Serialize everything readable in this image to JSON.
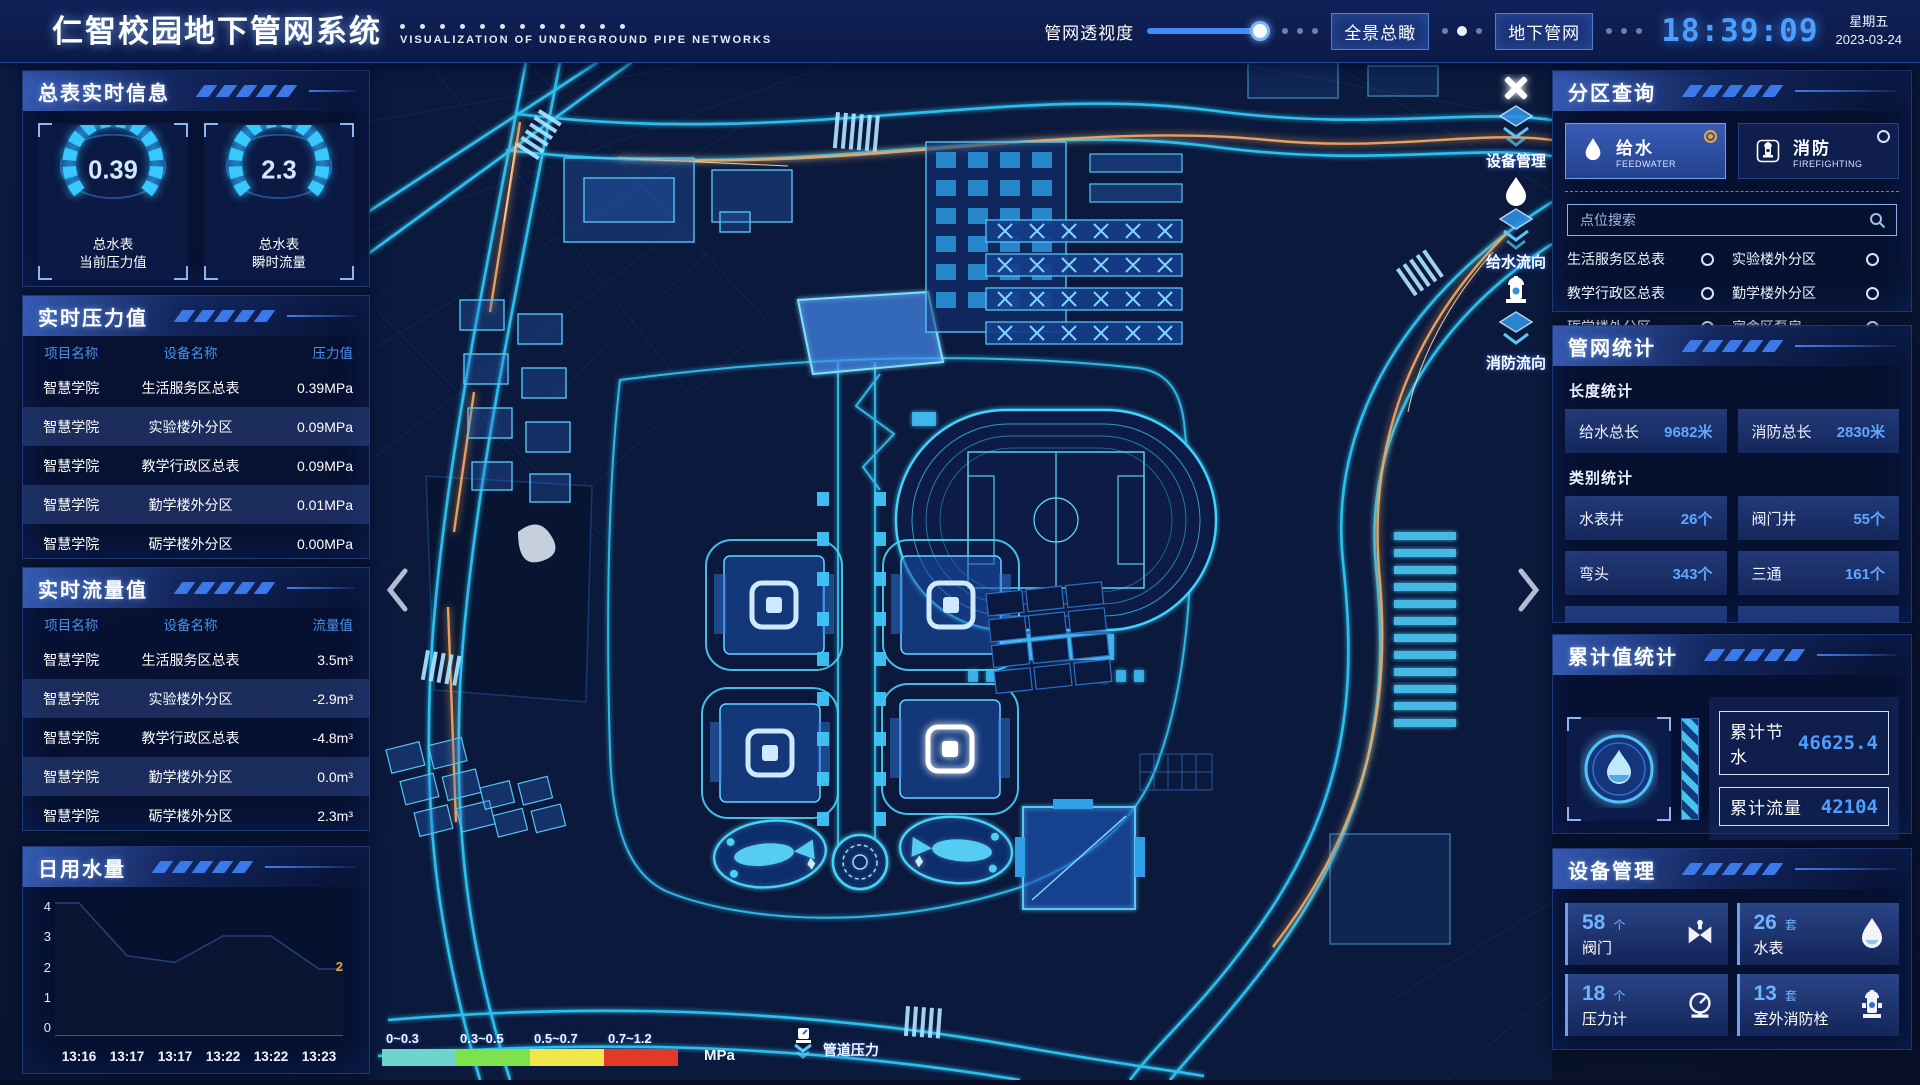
{
  "header": {
    "title": "仁智校园地下管网系统",
    "subtitle": "VISUALIZATION OF UNDERGROUND PIPE NETWORKS",
    "opacity_label": "管网透视度",
    "btn_overview": "全景总瞰",
    "btn_underground": "地下管网",
    "time": "18:39:09",
    "weekday": "星期五",
    "date": "2023-03-24"
  },
  "left": {
    "meter_panel": {
      "title": "总表实时信息",
      "gauges": [
        {
          "value": "0.39",
          "label1": "总水表",
          "label2": "当前压力值"
        },
        {
          "value": "2.3",
          "label1": "总水表",
          "label2": "瞬时流量"
        }
      ]
    },
    "pressure_panel": {
      "title": "实时压力值",
      "headers": [
        "项目名称",
        "设备名称",
        "压力值"
      ],
      "rows": [
        [
          "智慧学院",
          "生活服务区总表",
          "0.39MPa"
        ],
        [
          "智慧学院",
          "实验楼外分区",
          "0.09MPa"
        ],
        [
          "智慧学院",
          "教学行政区总表",
          "0.09MPa"
        ],
        [
          "智慧学院",
          "勤学楼外分区",
          "0.01MPa"
        ],
        [
          "智慧学院",
          "砺学楼外分区",
          "0.00MPa"
        ]
      ]
    },
    "flow_panel": {
      "title": "实时流量值",
      "headers": [
        "项目名称",
        "设备名称",
        "流量值"
      ],
      "rows": [
        [
          "智慧学院",
          "生活服务区总表",
          "3.5m³"
        ],
        [
          "智慧学院",
          "实验楼外分区",
          "-2.9m³"
        ],
        [
          "智慧学院",
          "教学行政区总表",
          "-4.8m³"
        ],
        [
          "智慧学院",
          "勤学楼外分区",
          "0.0m³"
        ],
        [
          "智慧学院",
          "砺学楼外分区",
          "2.3m³"
        ]
      ]
    },
    "daily_panel": {
      "title": "日用水量",
      "end_label": "2"
    }
  },
  "chart_data": {
    "type": "area",
    "title": "日用水量",
    "x": [
      "13:16",
      "13:17",
      "13:17",
      "13:22",
      "13:22",
      "13:23"
    ],
    "values": [
      4,
      2.4,
      2.2,
      3.0,
      3.0,
      2
    ],
    "yticks": [
      "0",
      "1",
      "2",
      "3",
      "4"
    ],
    "ylim": [
      0,
      4
    ],
    "xlabel": "",
    "ylabel": "",
    "grid": false,
    "legend": "none",
    "end_label": "2"
  },
  "right": {
    "query_panel": {
      "title": "分区查询",
      "tabs": [
        {
          "cn": "给水",
          "en": "FEEDWATER",
          "selected": true
        },
        {
          "cn": "消防",
          "en": "FIREFIGHTING",
          "selected": false
        }
      ],
      "search_placeholder": "点位搜索",
      "points": [
        "生活服务区总表",
        "实验楼外分区",
        "教学行政区总表",
        "勤学楼外分区",
        "砺学楼外分区",
        "宿舍区泵房"
      ]
    },
    "stats_panel": {
      "title": "管网统计",
      "length_title": "长度统计",
      "length_items": [
        {
          "label": "给水总长",
          "value": "9682米"
        },
        {
          "label": "消防总长",
          "value": "2830米"
        }
      ],
      "category_title": "类别统计",
      "category_items": [
        {
          "label": "水表井",
          "value": "26个"
        },
        {
          "label": "阀门井",
          "value": "55个"
        },
        {
          "label": "弯头",
          "value": "343个"
        },
        {
          "label": "三通",
          "value": "161个"
        }
      ]
    },
    "cumulative_panel": {
      "title": "累计值统计",
      "items": [
        {
          "label": "累计节水",
          "value": "46625.4"
        },
        {
          "label": "累计流量",
          "value": "42104"
        }
      ]
    },
    "device_panel": {
      "title": "设备管理",
      "devices": [
        {
          "count": "58",
          "unit": "个",
          "label": "阀门"
        },
        {
          "count": "26",
          "unit": "套",
          "label": "水表"
        },
        {
          "count": "18",
          "unit": "个",
          "label": "压力计"
        },
        {
          "count": "13",
          "unit": "套",
          "label": "室外消防栓"
        }
      ]
    }
  },
  "map": {
    "legend": {
      "ranges": [
        {
          "label": "0~0.3",
          "color": "#6fd4cf"
        },
        {
          "label": "0.3~0.5",
          "color": "#7de24d"
        },
        {
          "label": "0.5~0.7",
          "color": "#f1e74b"
        },
        {
          "label": "0.7~1.2",
          "color": "#e23a28"
        }
      ],
      "unit": "MPa",
      "pressure_label": "管道压力"
    },
    "markers": [
      "设备管理",
      "给水流向",
      "消防流向"
    ]
  },
  "colors": {
    "accent_blue": "#3f7ef0",
    "glow_cyan": "#2fc8f7",
    "pipe_orange": "#f2a75e",
    "clock_blue": "#4d9fff",
    "value_blue": "#5fa8ff",
    "selected_orange": "#f0a62e"
  }
}
